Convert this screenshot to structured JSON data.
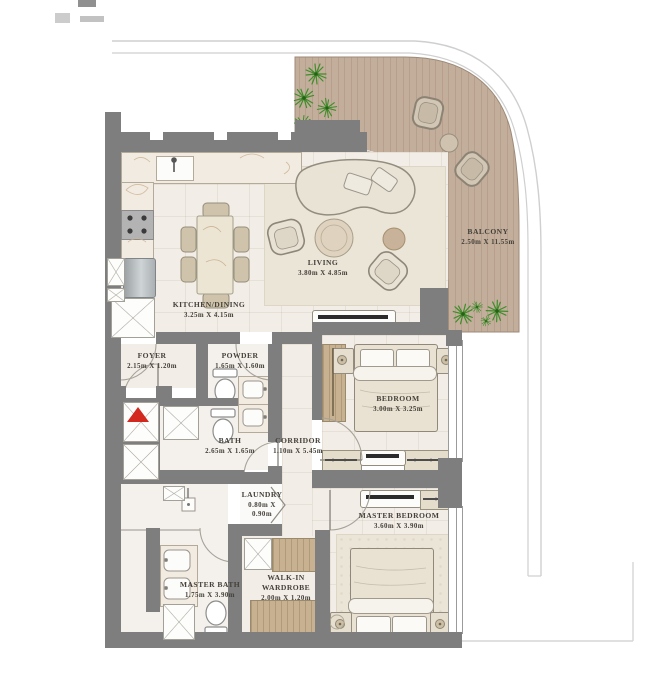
{
  "rooms": [
    {
      "name": "KITCHEN/DINING",
      "dims": "3.25m X 4.15m"
    },
    {
      "name": "LIVING",
      "dims": "3.80m X 4.85m"
    },
    {
      "name": "BALCONY",
      "dims": "2.50m X 11.55m"
    },
    {
      "name": "FOYER",
      "dims": "2.15m X 1.20m"
    },
    {
      "name": "POWDER",
      "dims": "1.65m X 1.60m"
    },
    {
      "name": "BEDROOM",
      "dims": "3.00m X 3.25m"
    },
    {
      "name": "BATH",
      "dims": "2.65m X 1.65m"
    },
    {
      "name": "CORRIDOR",
      "dims": "1.10m X 5.45m"
    },
    {
      "name": "LAUNDRY",
      "dims": "0.80m X 0.90m"
    },
    {
      "name": "MASTER BATH",
      "dims": "1.75m X 3.90m"
    },
    {
      "name": "WALK-IN WARDROBE",
      "dims": "2.00m X 1.20m"
    },
    {
      "name": "MASTER BEDROOM",
      "dims": "3.60m X 3.90m"
    }
  ],
  "colors": {
    "wall": "#7e7e7e",
    "deck": "#c2ae9b",
    "wood": "#c7b190",
    "plant": "#3f8d2b",
    "entrance_marker": "#d2281e",
    "floor": "#f2eee7"
  }
}
